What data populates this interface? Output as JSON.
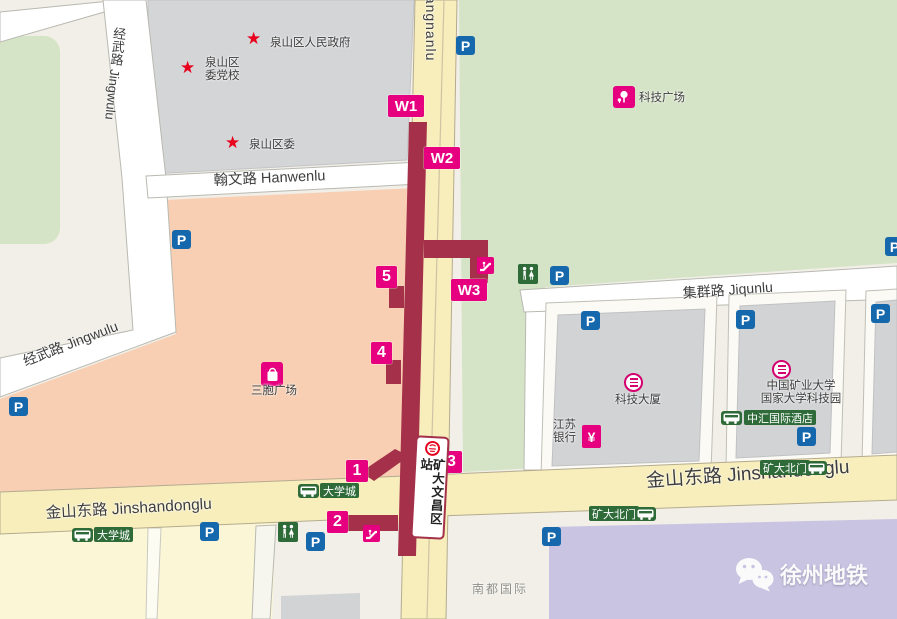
{
  "station": {
    "name": "矿大文昌区站"
  },
  "exits": {
    "w1": "W1",
    "w2": "W2",
    "w3": "W3",
    "n1": "1",
    "n2": "2",
    "n3": "3",
    "n4": "4",
    "n5": "5"
  },
  "roads": {
    "jingwulu": "经武路 Jingwulu",
    "jiefangnanlu": "Jiefangnanlu",
    "hanwenlu": "翰文路 Hanwenlu",
    "jiqunlu": "集群路 Jiqunlu",
    "jinshandonglu": "金山东路 Jinshandonglu"
  },
  "landmarks": {
    "star_glyph": "★",
    "district_gov": "泉山区人民政府",
    "party_school_line1": "泉山区",
    "party_school_line2": "委党校",
    "district_committee": "泉山区委",
    "keji_plaza": "科技广场",
    "sanbao_plaza": "三胞广场",
    "keji_tower": "科技大厦",
    "univ_park_line1": "中国矿业大学",
    "univ_park_line2": "国家大学科技园",
    "bank_line1": "江苏",
    "bank_line2": "银行",
    "yuan_glyph": "¥",
    "nandu_intl": "南都国际"
  },
  "bus_stops": {
    "daxuecheng": "大学城",
    "kuangda_north_gate": "矿大北门",
    "zhonghui_hotel": "中汇国际酒店"
  },
  "icons": {
    "parking_glyph": "P"
  },
  "watermark": {
    "text": "徐州地铁"
  },
  "colors": {
    "station_maroon": "#a43049",
    "exit_magenta": "#e6007f",
    "parking_blue": "#1668ad",
    "sign_green": "#2e6b39",
    "star_red": "#e8001c",
    "road_yellow": "#f7eebc",
    "block_salmon": "#f8cfb3",
    "block_green": "#d5e4c6",
    "block_gray": "#d4d5d7",
    "block_lavender": "#c9c4e1"
  }
}
